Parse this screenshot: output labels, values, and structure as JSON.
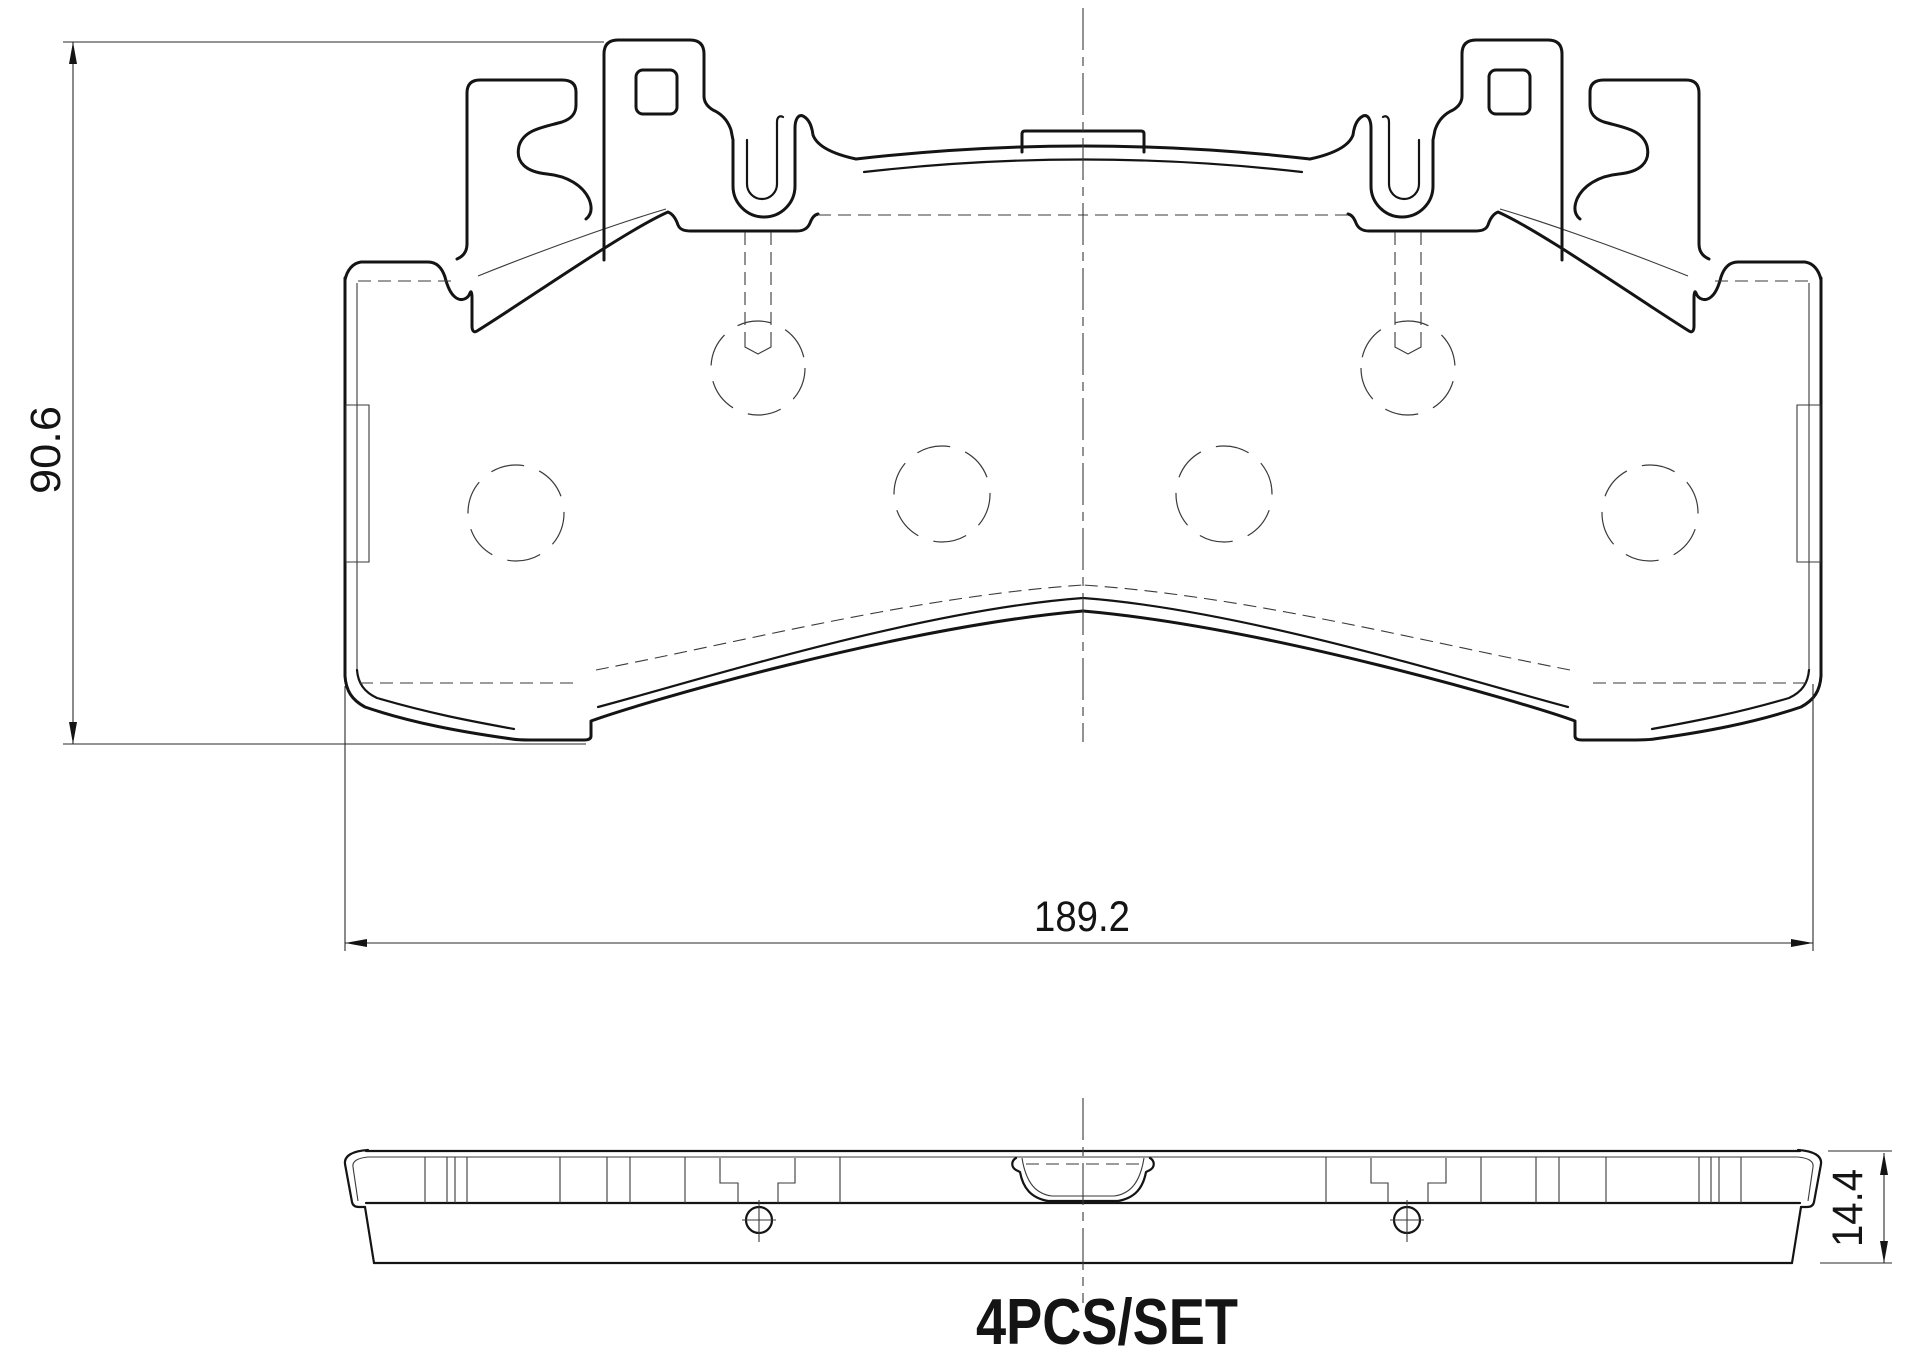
{
  "drawing": {
    "dimensions": {
      "height": "90.6",
      "width": "189.2",
      "thickness": "14.4"
    },
    "note": "4PCS/SET",
    "colors": {
      "line": "#141414",
      "thin_line": "#3a3a3a",
      "background": "#ffffff"
    }
  }
}
